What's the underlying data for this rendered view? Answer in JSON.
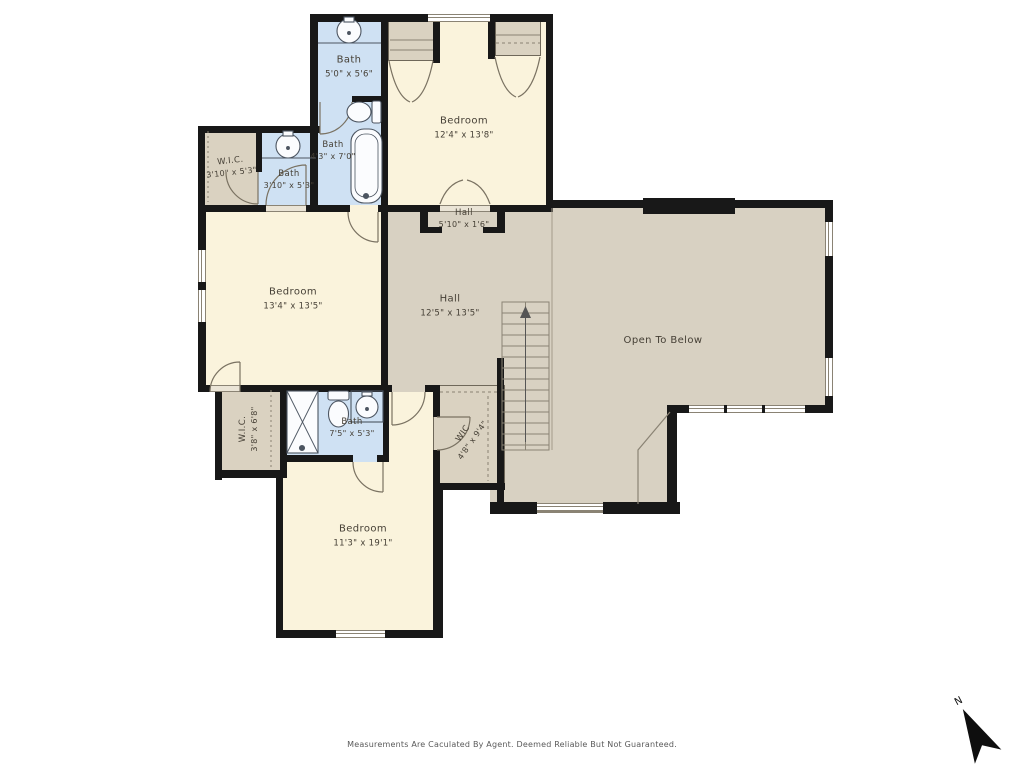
{
  "rooms": {
    "bath_top": {
      "name": "Bath",
      "dims": "5'0\" x 5'6\""
    },
    "bath_mid": {
      "name": "Bath",
      "dims": "4'3\" x 7'0\""
    },
    "bedroom_top": {
      "name": "Bedroom",
      "dims": "12'4\" x 13'8\""
    },
    "wic_left": {
      "name": "W.I.C.",
      "dims": "3'10\" x 5'3\""
    },
    "bath_left": {
      "name": "Bath",
      "dims": "3'10\" x 5'3\""
    },
    "hall_upper": {
      "name": "Hall",
      "dims": "5'10\" x 1'6\""
    },
    "bedroom_left": {
      "name": "Bedroom",
      "dims": "13'4\" x 13'5\""
    },
    "hall_main": {
      "name": "Hall",
      "dims": "12'5\" x 13'5\""
    },
    "open_below": {
      "name": "Open To Below",
      "dims": ""
    },
    "wic_lower_left": {
      "name": "W.I.C.",
      "dims": "3'8\" x 6'8\""
    },
    "bath_lower": {
      "name": "Bath",
      "dims": "7'5\" x 5'3\""
    },
    "wic_lower_right": {
      "name": "WIC",
      "dims": "4'8\" x 9'4\""
    },
    "bedroom_lower": {
      "name": "Bedroom",
      "dims": "11'3\" x 19'1\""
    }
  },
  "compass": {
    "north_label": "N"
  },
  "footer": {
    "disclaimer": "Measurements Are Caculated By Agent. Deemed Reliable But Not Guaranteed."
  },
  "colors": {
    "bath_fill": "#cfe1f3",
    "bedroom_fill": "#faf3dc",
    "hall_fill": "#d8d1c2",
    "closet_fill": "#dad2c1",
    "wall": "#181818"
  }
}
